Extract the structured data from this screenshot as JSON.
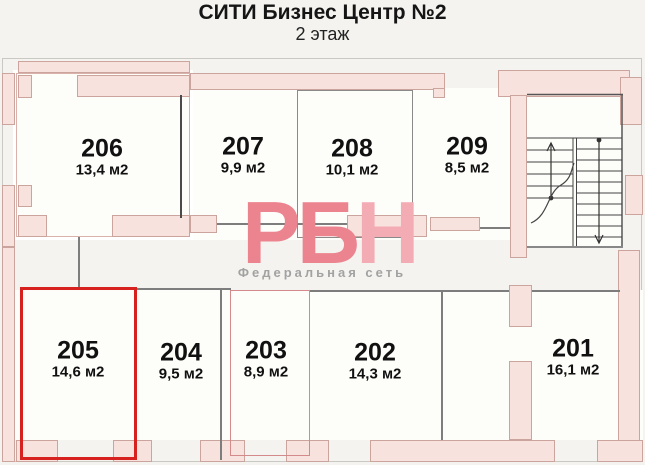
{
  "title": {
    "line1": "СИТИ Бизнес Центр №2",
    "line2": "2 этаж"
  },
  "watermark": {
    "logo": "РБН",
    "logo_dark_part": "РБ",
    "logo_light_part": "Н",
    "subtitle": "Федеральная сеть"
  },
  "highlighted_room": "205",
  "rooms": {
    "r206": {
      "number": "206",
      "area": "13,4 м2"
    },
    "r207": {
      "number": "207",
      "area": "9,9 м2"
    },
    "r208": {
      "number": "208",
      "area": "10,1 м2"
    },
    "r209": {
      "number": "209",
      "area": "8,5 м2"
    },
    "r205": {
      "number": "205",
      "area": "14,6 м2"
    },
    "r204": {
      "number": "204",
      "area": "9,5 м2"
    },
    "r203": {
      "number": "203",
      "area": "8,9 м2"
    },
    "r202": {
      "number": "202",
      "area": "14,3 м2"
    },
    "r201": {
      "number": "201",
      "area": "16,1 м2"
    }
  },
  "colors": {
    "wall_fill": "#f8e2dd",
    "wall_border": "#cba59d",
    "door_gray": "#7d7d7d",
    "line_dark": "#4a4a4a",
    "highlight": "#d7211e",
    "outline_203": "#d4898b",
    "logo": "#ec8490",
    "logo_light": "#f3abb4",
    "subtitle_gray": "#a2a2a2",
    "text": "#111111"
  }
}
